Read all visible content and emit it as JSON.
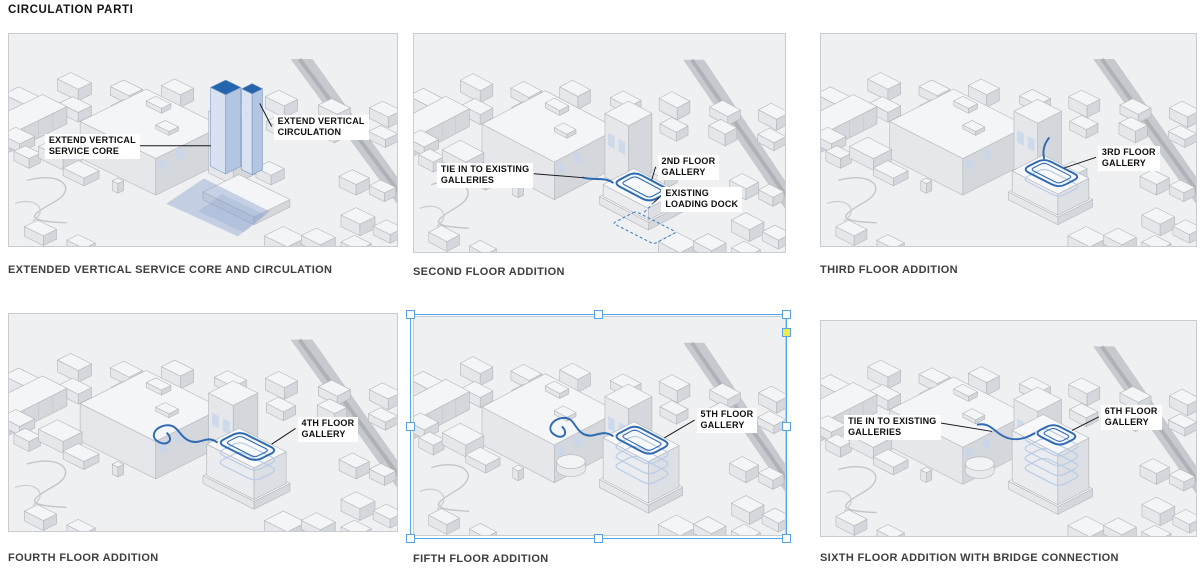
{
  "page": {
    "title": "CIRCULATION PARTI"
  },
  "colors": {
    "accent_blue": "#2f6ab2",
    "accent_blue_light": "#b9cbe6",
    "tower_top_blue": "#2565ae",
    "wash_blue": "#7d96c8",
    "dock_dash_blue": "#4a7fc1",
    "selection_blue": "#58a3e8",
    "handle_yellow": "#eceb52",
    "panel_bg": "#eef0f2",
    "panel_border": "#c9ccd0",
    "label_bg": "#ffffff",
    "label_text": "#0e0e0e",
    "leader_line": "#17171a",
    "caption_text": "#3e3e3e",
    "title_text": "#141414"
  },
  "panels": [
    {
      "caption": "EXTENDED VERTICAL SERVICE CORE AND CIRCULATION",
      "selected": false,
      "labels": [
        {
          "text": "EXTEND VERTICAL\nSERVICE CORE",
          "x": 36,
          "y": 104,
          "leader": [
            126,
            116,
            203,
            116
          ]
        },
        {
          "text": "EXTEND VERTICAL\nCIRCULATION",
          "x": 266,
          "y": 84,
          "leader": [
            264,
            96,
            252,
            72
          ]
        }
      ]
    },
    {
      "caption": "SECOND FLOOR ADDITION",
      "selected": false,
      "labels": [
        {
          "text": "TIE IN TO EXISTING\nGALLERIES",
          "x": 24,
          "y": 130,
          "leader": [
            126,
            141,
            178,
            145
          ]
        },
        {
          "text": "2ND FLOOR\nGALLERY",
          "x": 256,
          "y": 122,
          "leader": [
            254,
            134,
            250,
            147
          ]
        },
        {
          "text": "EXISTING\nLOADING DOCK",
          "x": 260,
          "y": 154,
          "leader": [
            258,
            165,
            252,
            170
          ]
        }
      ]
    },
    {
      "caption": "THIRD FLOOR ADDITION",
      "selected": false,
      "labels": [
        {
          "text": "3RD FLOOR\nGALLERY",
          "x": 288,
          "y": 116,
          "leader": [
            286,
            128,
            253,
            139
          ]
        }
      ]
    },
    {
      "caption": "FOURTH FLOOR ADDITION",
      "selected": false,
      "labels": [
        {
          "text": "4TH FLOOR\nGALLERY",
          "x": 290,
          "y": 104,
          "leader": [
            288,
            116,
            264,
            132
          ]
        }
      ]
    },
    {
      "caption": "FIFTH FLOOR ADDITION",
      "selected": true,
      "labels": [
        {
          "text": "5TH FLOOR\nGALLERY",
          "x": 297,
          "y": 92,
          "leader": [
            295,
            104,
            263,
            122
          ]
        }
      ]
    },
    {
      "caption": "SIXTH FLOOR ADDITION WITH BRIDGE CONNECTION",
      "selected": false,
      "labels": [
        {
          "text": "TIE IN TO EXISTING\nGALLERIES",
          "x": 24,
          "y": 96,
          "leader": [
            122,
            104,
            178,
            113
          ]
        },
        {
          "text": "6TH FLOOR\nGALLERY",
          "x": 291,
          "y": 86,
          "leader": [
            289,
            98,
            261,
            112
          ]
        }
      ]
    }
  ]
}
